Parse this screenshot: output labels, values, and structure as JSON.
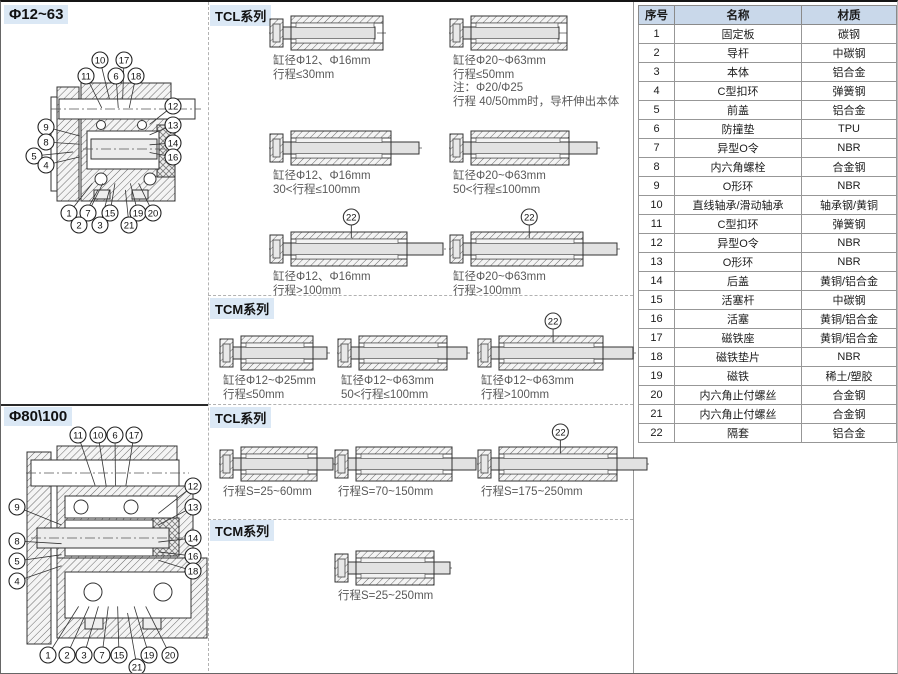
{
  "sections": {
    "left_top_title": "Φ12~63",
    "left_bottom_title": "Φ80\\100",
    "tcl_top_header": "TCL系列",
    "tcm_top_header": "TCM系列",
    "tcl_bottom_header": "TCL系列",
    "tcm_bottom_header": "TCM系列"
  },
  "colors": {
    "section_chip_bg": "#dbe8f5",
    "table_header_bg": "#c9d8ea",
    "caption_text": "#595959",
    "line_gray": "#b2b2b2"
  },
  "callout_22_label": "22",
  "cylinders": [
    {
      "group": "tcl-top",
      "x": 268,
      "cy": 12,
      "w": 92,
      "ext": 0,
      "has22": false,
      "captions": [
        "缸径Φ12、Φ16mm",
        "行程≤30mm"
      ]
    },
    {
      "group": "tcl-top",
      "x": 448,
      "cy": 12,
      "w": 96,
      "ext": 0,
      "has22": false,
      "captions": [
        "缸径Φ20~Φ63mm",
        "行程≤50mm",
        "注：Φ20/Φ25",
        "行程 40/50mm时，导杆伸出本体"
      ]
    },
    {
      "group": "tcl-top",
      "x": 268,
      "cy": 127,
      "w": 100,
      "ext": 28,
      "has22": false,
      "captions": [
        "缸径Φ12、Φ16mm",
        "30<行程≤100mm"
      ]
    },
    {
      "group": "tcl-top",
      "x": 448,
      "cy": 127,
      "w": 98,
      "ext": 28,
      "has22": false,
      "captions": [
        "缸径Φ20~Φ63mm",
        "50<行程≤100mm"
      ]
    },
    {
      "group": "tcl-top",
      "x": 268,
      "cy": 228,
      "w": 116,
      "ext": 36,
      "has22": true,
      "captions": [
        "缸径Φ12、Φ16mm",
        "行程>100mm"
      ]
    },
    {
      "group": "tcl-top",
      "x": 448,
      "cy": 228,
      "w": 112,
      "ext": 34,
      "has22": true,
      "captions": [
        "缸径Φ20~Φ63mm",
        "行程>100mm"
      ]
    },
    {
      "group": "tcm-top",
      "x": 218,
      "cy": 332,
      "w": 72,
      "ext": 14,
      "has22": false,
      "captions": [
        "缸径Φ12~Φ25mm",
        "行程≤50mm"
      ]
    },
    {
      "group": "tcm-top",
      "x": 336,
      "cy": 332,
      "w": 88,
      "ext": 20,
      "has22": false,
      "captions": [
        "缸径Φ12~Φ63mm",
        "50<行程≤100mm"
      ]
    },
    {
      "group": "tcm-top",
      "x": 476,
      "cy": 332,
      "w": 104,
      "ext": 30,
      "has22": true,
      "captions": [
        "缸径Φ12~Φ63mm",
        "行程>100mm"
      ]
    },
    {
      "group": "tcl-bottom",
      "x": 218,
      "cy": 443,
      "w": 76,
      "ext": 16,
      "has22": false,
      "captions": [
        "行程S=25~60mm"
      ]
    },
    {
      "group": "tcl-bottom",
      "x": 333,
      "cy": 443,
      "w": 96,
      "ext": 24,
      "has22": false,
      "captions": [
        "行程S=70~150mm"
      ]
    },
    {
      "group": "tcl-bottom",
      "x": 476,
      "cy": 443,
      "w": 118,
      "ext": 30,
      "has22": true,
      "captions": [
        "行程S=175~250mm"
      ]
    },
    {
      "group": "tcm-bottom",
      "x": 333,
      "cy": 547,
      "w": 78,
      "ext": 16,
      "has22": false,
      "captions": [
        "行程S=25~250mm"
      ]
    }
  ],
  "drawings": {
    "top": {
      "callouts": [
        {
          "n": "10",
          "x": 99,
          "y": 58
        },
        {
          "n": "17",
          "x": 123,
          "y": 58
        },
        {
          "n": "11",
          "x": 85,
          "y": 74
        },
        {
          "n": "6",
          "x": 115,
          "y": 74
        },
        {
          "n": "18",
          "x": 135,
          "y": 74
        },
        {
          "n": "12",
          "x": 172,
          "y": 104
        },
        {
          "n": "9",
          "x": 45,
          "y": 125
        },
        {
          "n": "13",
          "x": 172,
          "y": 123
        },
        {
          "n": "8",
          "x": 45,
          "y": 140
        },
        {
          "n": "14",
          "x": 172,
          "y": 141
        },
        {
          "n": "5",
          "x": 33,
          "y": 154
        },
        {
          "n": "16",
          "x": 172,
          "y": 155
        },
        {
          "n": "4",
          "x": 45,
          "y": 163
        },
        {
          "n": "1",
          "x": 68,
          "y": 211
        },
        {
          "n": "7",
          "x": 87,
          "y": 211
        },
        {
          "n": "15",
          "x": 109,
          "y": 211
        },
        {
          "n": "19",
          "x": 137,
          "y": 211
        },
        {
          "n": "20",
          "x": 152,
          "y": 211
        },
        {
          "n": "2",
          "x": 78,
          "y": 223
        },
        {
          "n": "3",
          "x": 99,
          "y": 223
        },
        {
          "n": "21",
          "x": 128,
          "y": 223
        }
      ]
    },
    "bottom": {
      "callouts": [
        {
          "n": "11",
          "x": 77,
          "y": 433
        },
        {
          "n": "10",
          "x": 97,
          "y": 433
        },
        {
          "n": "6",
          "x": 114,
          "y": 433
        },
        {
          "n": "17",
          "x": 133,
          "y": 433
        },
        {
          "n": "12",
          "x": 192,
          "y": 484
        },
        {
          "n": "9",
          "x": 16,
          "y": 505
        },
        {
          "n": "13",
          "x": 192,
          "y": 505
        },
        {
          "n": "8",
          "x": 16,
          "y": 539
        },
        {
          "n": "14",
          "x": 192,
          "y": 536
        },
        {
          "n": "5",
          "x": 16,
          "y": 559
        },
        {
          "n": "16",
          "x": 192,
          "y": 554
        },
        {
          "n": "4",
          "x": 16,
          "y": 579
        },
        {
          "n": "18",
          "x": 192,
          "y": 569
        },
        {
          "n": "1",
          "x": 47,
          "y": 653
        },
        {
          "n": "2",
          "x": 66,
          "y": 653
        },
        {
          "n": "3",
          "x": 83,
          "y": 653
        },
        {
          "n": "7",
          "x": 101,
          "y": 653
        },
        {
          "n": "15",
          "x": 118,
          "y": 653
        },
        {
          "n": "19",
          "x": 148,
          "y": 653
        },
        {
          "n": "20",
          "x": 169,
          "y": 653
        },
        {
          "n": "21",
          "x": 136,
          "y": 665
        }
      ]
    }
  },
  "table": {
    "headers": [
      "序号",
      "名称",
      "材质"
    ],
    "rows": [
      [
        "1",
        "固定板",
        "碳钢"
      ],
      [
        "2",
        "导杆",
        "中碳钢"
      ],
      [
        "3",
        "本体",
        "铝合金"
      ],
      [
        "4",
        "C型扣环",
        "弹簧钢"
      ],
      [
        "5",
        "前盖",
        "铝合金"
      ],
      [
        "6",
        "防撞垫",
        "TPU"
      ],
      [
        "7",
        "异型O令",
        "NBR"
      ],
      [
        "8",
        "内六角螺栓",
        "合金钢"
      ],
      [
        "9",
        "O形环",
        "NBR"
      ],
      [
        "10",
        "直线轴承/滑动轴承",
        "轴承钢/黄铜"
      ],
      [
        "11",
        "C型扣环",
        "弹簧钢"
      ],
      [
        "12",
        "异型O令",
        "NBR"
      ],
      [
        "13",
        "O形环",
        "NBR"
      ],
      [
        "14",
        "后盖",
        "黄铜/铝合金"
      ],
      [
        "15",
        "活塞杆",
        "中碳钢"
      ],
      [
        "16",
        "活塞",
        "黄铜/铝合金"
      ],
      [
        "17",
        "磁铁座",
        "黄铜/铝合金"
      ],
      [
        "18",
        "磁铁垫片",
        "NBR"
      ],
      [
        "19",
        "磁铁",
        "稀土/塑胶"
      ],
      [
        "20",
        "内六角止付螺丝",
        "合金钢"
      ],
      [
        "21",
        "内六角止付螺丝",
        "合金钢"
      ],
      [
        "22",
        "隔套",
        "铝合金"
      ]
    ]
  }
}
